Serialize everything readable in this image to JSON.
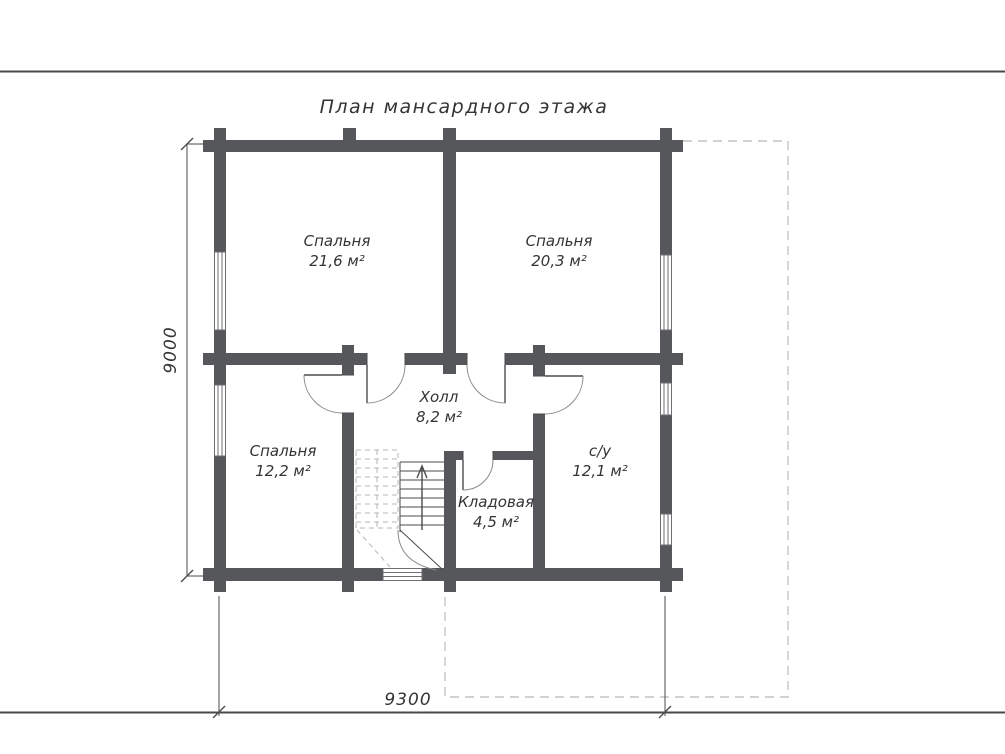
{
  "page": {
    "title": "План мансардного этажа"
  },
  "rooms": {
    "bedroom_top_left": {
      "name": "Спальня",
      "area": "21,6 м²"
    },
    "bedroom_top_right": {
      "name": "Спальня",
      "area": "20,3 м²"
    },
    "bedroom_bottom_left": {
      "name": "Спальня",
      "area": "12,2 м²"
    },
    "hall": {
      "name": "Холл",
      "area": "8,2 м²"
    },
    "storage": {
      "name": "Кладовая",
      "area": "4,5 м²"
    },
    "bathroom": {
      "name": "с/у",
      "area": "12,1 м²"
    }
  },
  "dimensions": {
    "vertical": "9000",
    "horizontal": "9300"
  },
  "colors": {
    "wall": "#56575b",
    "line": "#4b4b4d",
    "dash": "#c4c4c4",
    "text": "#333436",
    "rule": "#4a4a4c"
  }
}
